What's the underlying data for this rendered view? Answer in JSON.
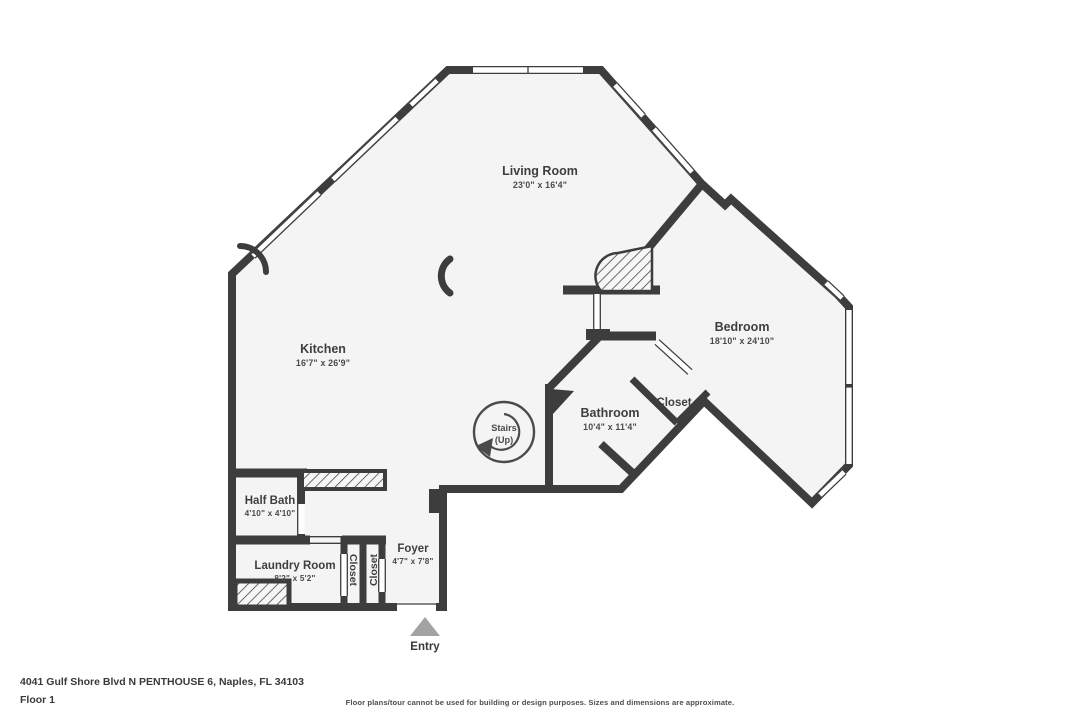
{
  "colors": {
    "wall": "#3d3d3d",
    "floor": "#f4f4f4",
    "window": "#ffffff",
    "entry_arrow": "#a3a3a3",
    "label_text": "#3f3f3f"
  },
  "rooms": {
    "living_room": {
      "name": "Living Room",
      "dims": "23'0\" x 16'4\""
    },
    "kitchen": {
      "name": "Kitchen",
      "dims": "16'7\" x 26'9\""
    },
    "bedroom": {
      "name": "Bedroom",
      "dims": "18'10\" x 24'10\""
    },
    "bathroom": {
      "name": "Bathroom",
      "dims": "10'4\" x 11'4\""
    },
    "half_bath": {
      "name": "Half Bath",
      "dims": "4'10\" x 4'10\""
    },
    "laundry": {
      "name": "Laundry Room",
      "dims": "8'2\" x 5'2\""
    },
    "foyer": {
      "name": "Foyer",
      "dims": "4'7\" x 7'8\""
    },
    "closet_hall": {
      "name": "Closet"
    },
    "closet_1": {
      "name": "Closet"
    },
    "closet_2": {
      "name": "Closet"
    }
  },
  "stairs": {
    "line1": "Stairs",
    "line2": "(Up)"
  },
  "entry": {
    "label": "Entry"
  },
  "footer": {
    "address": "4041 Gulf Shore Blvd N PENTHOUSE 6, Naples, FL 34103",
    "floor": "Floor 1",
    "disclaimer": "Floor plans/tour cannot be used for building or design purposes. Sizes and dimensions are approximate."
  }
}
